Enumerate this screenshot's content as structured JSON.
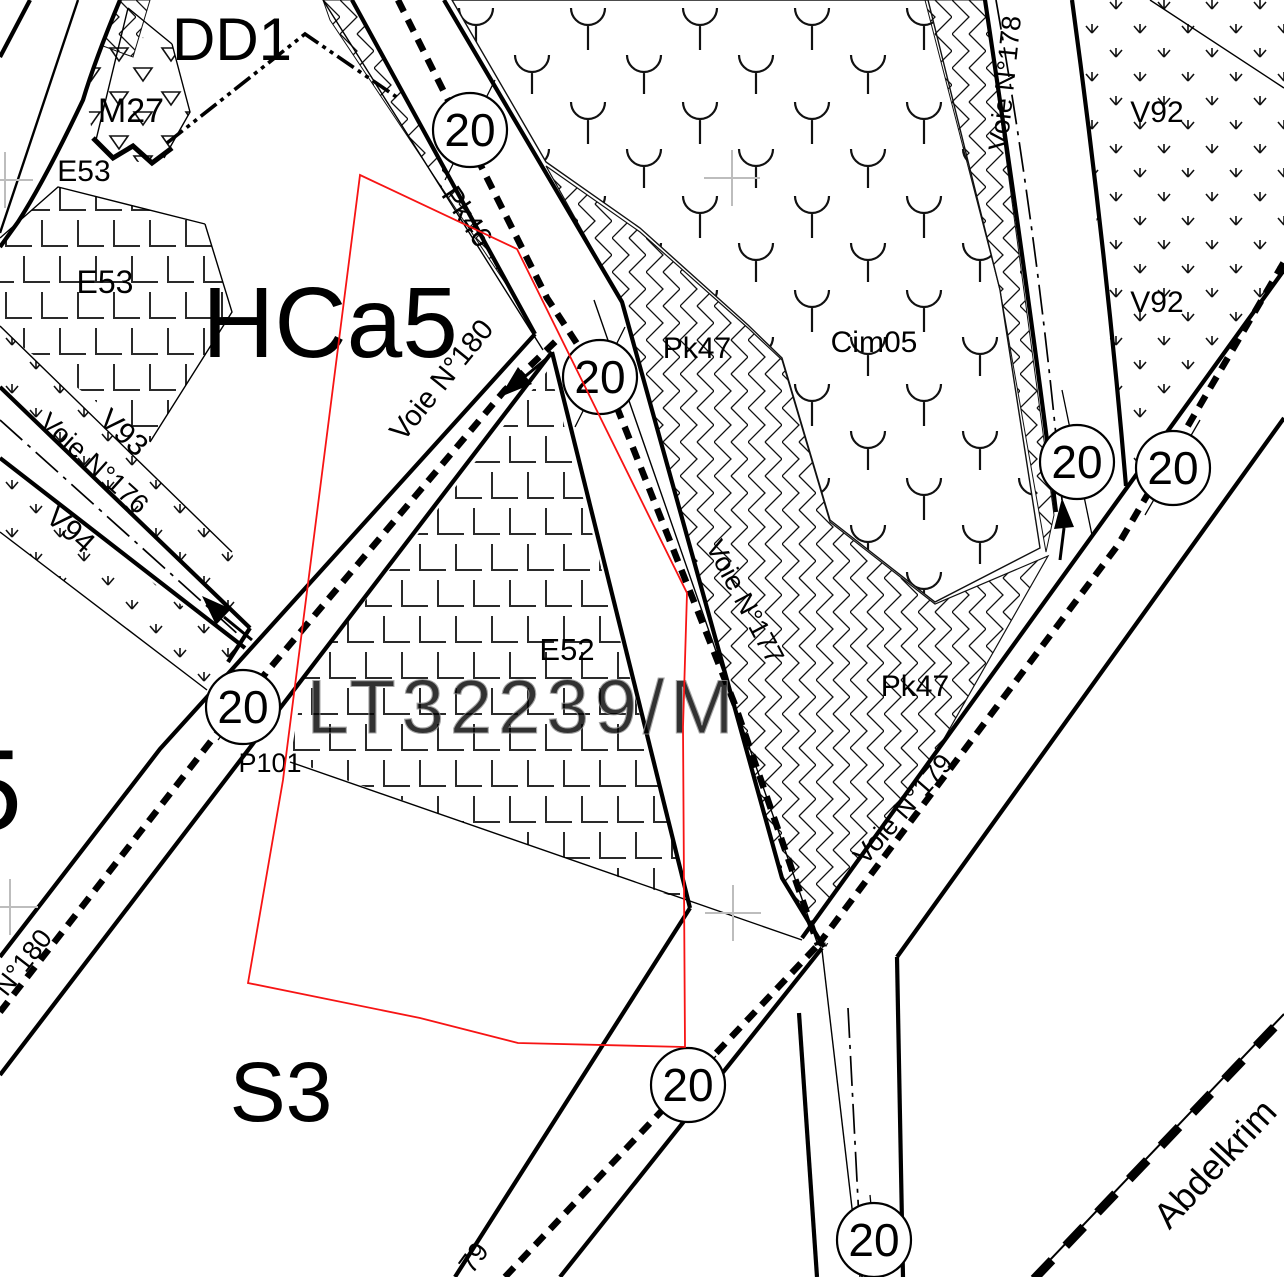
{
  "colors": {
    "parcel_red": "#f71414",
    "survey_cross": "#bdbdbd",
    "watermark_gray": "#8f8f8f",
    "ink": "#000000"
  },
  "watermark": {
    "text": "LT32239/M"
  },
  "zones": {
    "dd1": "DD1",
    "m27": "M27",
    "e53_upper": "E53",
    "e53_lower": "E53",
    "hca5": "HCa5",
    "e52": "E52",
    "s3": "S3",
    "v92_upper": "V92",
    "v92_lower": "V92",
    "v93": "V93",
    "v94": "V94",
    "pk46": "Pk46",
    "pk47_upper": "Pk47",
    "pk47_lower": "Pk47",
    "cim05": "Cim05",
    "p101": "P101",
    "sector_partial": "5"
  },
  "roads": {
    "voie176": "Voie N°176",
    "voie177": "Voie N°177",
    "voie178": "Voie N°178",
    "voie179": "Voie N°179",
    "voie180": "Voie N°180",
    "n180_partial": "N°180",
    "n179_partial": "79",
    "abdelkrim": "Abdelkrim"
  },
  "badges": [
    {
      "value": "20"
    },
    {
      "value": "20"
    },
    {
      "value": "20"
    },
    {
      "value": "20"
    },
    {
      "value": "20"
    },
    {
      "value": "20"
    },
    {
      "value": "20"
    }
  ]
}
